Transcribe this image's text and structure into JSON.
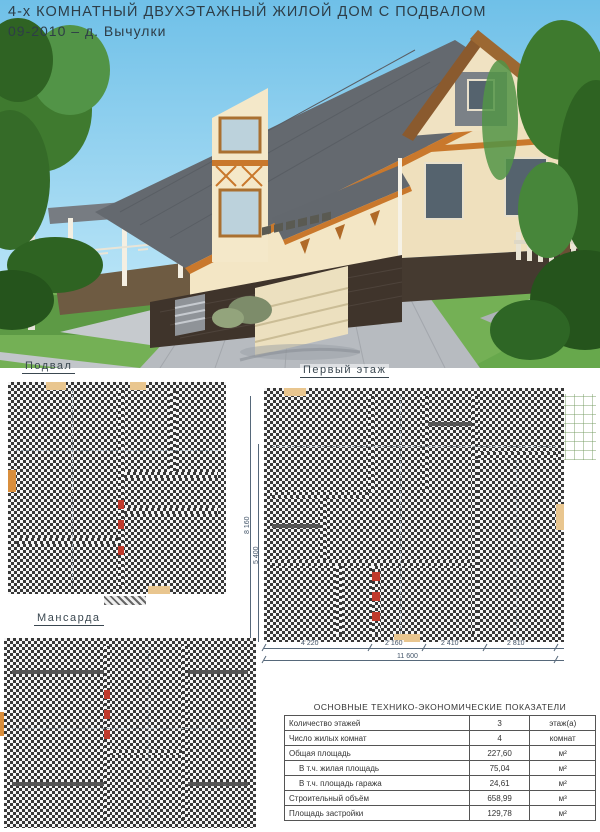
{
  "page": {
    "title_line1": "4-х КОМНАТНЫЙ ДВУХЭТАЖНЫЙ ЖИЛОЙ ДОМ С ПОДВАЛОМ",
    "title_line2": "09-2010 – д. Вычулки"
  },
  "colors": {
    "roof": "#64696f",
    "trim_orange": "#c9782c",
    "wall_cream": "#f3e6c5",
    "plinth_dark": "#40352c",
    "label_blue": "#3f4fc4",
    "room_pink": "#f6e2ee",
    "room_green": "#e2efc6",
    "room_blue": "#aed6e6",
    "room_purple": "#b9b4d8",
    "room_yellow": "#e2ec9b",
    "room_teal": "#8fd4c8"
  },
  "plans": {
    "basement": {
      "label": "Подвал",
      "rooms": {
        "garage": {
          "name": "Гараж",
          "area": "24.61"
        },
        "stairs": {
          "area": "6.54"
        },
        "storage1": {
          "name": "Кладовая",
          "area": "7.29"
        },
        "hall": {
          "area": "5.84"
        },
        "boiler": {
          "name": "Топочная",
          "area": "4.92"
        },
        "storage2": {
          "name": "Кладовая",
          "area": "6.82"
        },
        "cellar": {
          "area": "5.77"
        }
      }
    },
    "first_floor": {
      "label": "Первый этаж",
      "rooms": {
        "bedroom": {
          "name": "Спальня",
          "area": "14.73"
        },
        "wardrobe": {
          "name": "Гардероб",
          "area": "1.70"
        },
        "hall2": {
          "area": "2.12"
        },
        "bathroom": {
          "name": "Ванная",
          "area": "6.27"
        },
        "wc": {
          "name": "С/У",
          "area": "1.89"
        },
        "kitchen": {
          "name": "Кухня",
          "area": "13.04"
        },
        "living": {
          "name": "Гостиная",
          "area": "19.18"
        },
        "hall": {
          "area": "16.76"
        },
        "entry": {
          "area": "1.91"
        },
        "tambour": {
          "area": "3.79"
        },
        "terrace": {
          "name": "Терраса"
        }
      },
      "dimensions": {
        "h": [
          "4 220",
          "2 160",
          "2 410",
          "2 810"
        ],
        "total": "11 600",
        "v_outer": "8 160",
        "v_inner": "5 400"
      }
    },
    "attic": {
      "label": "Мансарда",
      "rooms": {
        "nook_tl": {
          "area": "4.75"
        },
        "nook_tr": {
          "area": "4.56"
        },
        "bedroom_l": {
          "name": "Спальня",
          "area": "20.99"
        },
        "bedroom_r": {
          "name": "Спальня",
          "area": "20.14"
        },
        "stairs": {
          "area": "9.73"
        },
        "hall": {
          "area": "6.22"
        },
        "wardrobe": {
          "name": "Гардероб",
          "area": "10.17"
        },
        "nook_bl": {
          "area": "5.34"
        },
        "nook_br": {
          "area": "5.32"
        }
      }
    }
  },
  "table": {
    "title": "ОСНОВНЫЕ ТЕХНИКО-ЭКОНОМИЧЕСКИЕ ПОКАЗАТЕЛИ",
    "rows": [
      {
        "label": "Количество этажей",
        "value": "3",
        "unit": "этаж(а)"
      },
      {
        "label": "Число жилых комнат",
        "value": "4",
        "unit": "комнат"
      },
      {
        "label": "Общая площадь",
        "value": "227,60",
        "unit": "м²"
      },
      {
        "label": "В т.ч. жилая площадь",
        "value": "75,04",
        "unit": "м²"
      },
      {
        "label": "В т.ч. площадь гаража",
        "value": "24,61",
        "unit": "м²"
      },
      {
        "label": "Строительный объём",
        "value": "658,99",
        "unit": "м³"
      },
      {
        "label": "Площадь застройки",
        "value": "129,78",
        "unit": "м²"
      }
    ]
  }
}
